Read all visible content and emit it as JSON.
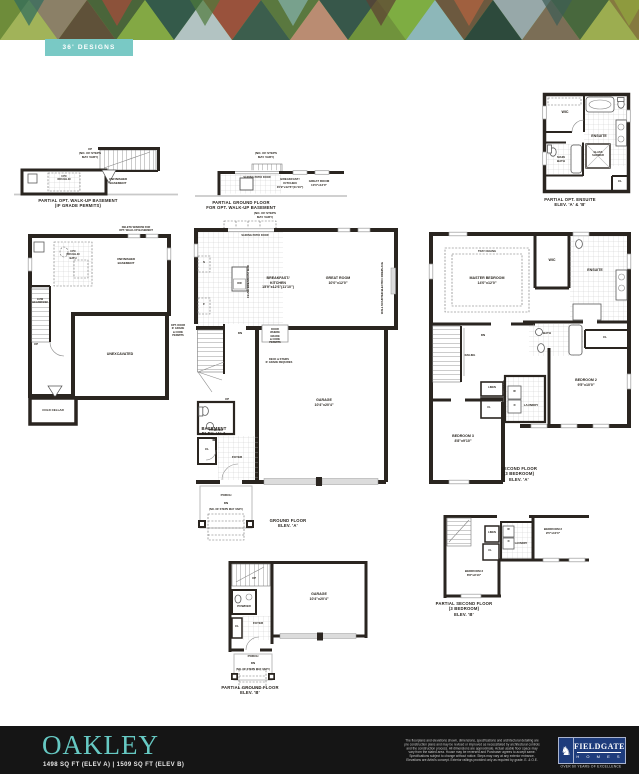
{
  "header": {
    "ribbon": "36' DESIGNS"
  },
  "colors": {
    "ribbon_teal": "#79c9c5",
    "accent_teal": "#66c9c3",
    "footer_bg": "#151515",
    "logo_blue": "#1e3c7c",
    "wall_ink": "#2a2520"
  },
  "plans": {
    "walkup_basement": {
      "up_note": "UP\n(NO. OF STEPS\nMAY VARY)",
      "rough_in": "3 PC\nROUGH-IN",
      "room": "UNFINISHED\nBASEMENT",
      "caption": "PARTIAL OPT. WALK-UP BASEMENT\n(IF GRADE PERMITS)"
    },
    "walkup_ground": {
      "steps_note": "(NO. OF STEPS\nMAY VARY)",
      "patio_door": "SLIDING PATIO DOOR",
      "kitchen": "BREAKFAST/\nKITCHEN\n15'9\"x12'6\"(11'10\")",
      "great_room": "GREAT ROOM\n10'0\"x12'0\"",
      "caption": "PARTIAL GROUND FLOOR\nFOR OPT. WALK-UP BASEMENT"
    },
    "opt_ensuite": {
      "wic": "WIC",
      "ensuite": "ENSUITE",
      "main_bath": "MAIN\nBATH",
      "shower": "GLASS\nSHOWER",
      "closet": "CL",
      "caption": "PARTIAL OPT. ENSUITE\nELEV. 'A' & 'B'"
    },
    "basement": {
      "delete_window": "DELETE WINDOW FOR\nOPT. WALK-UP BASEMENT",
      "rough_in": "3 PC\nROUGH-IN\nBATH",
      "room": "UNFINISHED\nBASEMENT",
      "low_headroom": "LOW\nHEADROOM",
      "up": "UP",
      "unexcavated": "UNEXCAVATED",
      "cold_cellar": "COLD CELLAR",
      "caption": "BASEMENT\nELEV. 'A' & 'B'"
    },
    "ground_floor": {
      "steps_note_top": "(NO. OF STEPS\nMAY VARY)",
      "patio_door": "SLIDING PATIO DOOR",
      "kitchen": "BREAKFAST/\nKITCHEN\n15'9\"x12'6\"(11'10\")",
      "great_room": "GREAT ROOM\n10'0\"x12'0\"",
      "fireplace": "WALL MOUNTED ELECTRIC FIREPLACE",
      "breakfast_bar": "FLUSH BREAKFAST BAR",
      "sink": "S",
      "fridge": "F",
      "dishwasher": "DW",
      "dn": "DN",
      "up": "UP",
      "opt_door": "OPT. DOOR\nIF GRADE\n& CODE\nPERMITS",
      "door_grade": "DOOR\nWHERE\nGRADE\n& CODE\nPERMITS",
      "deck_note": "DECK & STAIRS\nIF GRADE REQUIRES",
      "garage": "GARAGE\n10'4\"x20'4\"",
      "powder": "POWDER",
      "foyer": "FOYER",
      "closet": "CL",
      "porch": "PORCH",
      "porch_dn": "DN",
      "steps_note": "(NO. OF STEPS MAY VARY)",
      "caption": "GROUND FLOOR\nELEV. 'A'"
    },
    "second_floor": {
      "tray": "TRAY CEILING",
      "master": "MASTER BEDROOM\n14'0\"x12'0\"",
      "wic": "WIC",
      "ensuite": "ENSUITE",
      "dn": "DN",
      "railing": "RAILING",
      "bath": "BATH",
      "closet": "CL",
      "linen": "LINEN",
      "closet2": "CL",
      "laundry": "LAUNDRY",
      "opt_uppers": "OPT. UPPERS",
      "washer": "W",
      "dryer": "D",
      "bedroom2": "BEDROOM 2\n9'5\"x10'0\"",
      "bedroom3": "BEDROOM 3\n8'8\"x9'10\"",
      "caption": "SECOND FLOOR\n(3 BEDROOM)\nELEV. 'A'"
    },
    "partial_ground_b": {
      "up": "UP",
      "powder": "POWDER",
      "foyer": "FOYER",
      "closet": "CL",
      "garage": "GARAGE\n10'4\"x20'4\"",
      "porch": "PORCH",
      "dn": "DN",
      "steps_note": "(NO. OF STEPS MAY VARY)",
      "caption": "PARTIAL GROUND FLOOR\nELEV. 'B'"
    },
    "partial_second_b": {
      "linen": "LINEN",
      "closet": "CL",
      "laundry": "LAUNDRY",
      "washer": "W",
      "dryer": "D",
      "bedroom2": "BEDROOM 2\n9'5\"x10'0\"",
      "bedroom3": "BEDROOM 3\n8'8\"x9'10\"",
      "caption": "PARTIAL SECOND FLOOR\n(3 BEDROOM)\nELEV. 'B'"
    }
  },
  "footer": {
    "model": "OAKLEY",
    "sqft": "1498 SQ FT (ELEV A)  |  1509 SQ FT (ELEV B)",
    "disclaimer": "The floorplans and elevations shown, dimensions, specifications and architectural detailing are pre construction plans and may be revised or improved as necessitated by architectural controls and the construction process. All dimensions are approximate. Actual usable floor space may vary from the stated area. House may be reversed and Purchaser agrees to accept same. Specifications subject to change without notice. Steps may vary at any exterior entrance. Elevations are Artist's concept. Exterior railings provided only as required by grade. E. & O.E.",
    "logo": {
      "emblem_glyph": "♞",
      "brand": "FIELDGATE",
      "homes": "H O M E S",
      "tagline": "OVER 60 YEARS OF EXCELLENCE"
    }
  }
}
